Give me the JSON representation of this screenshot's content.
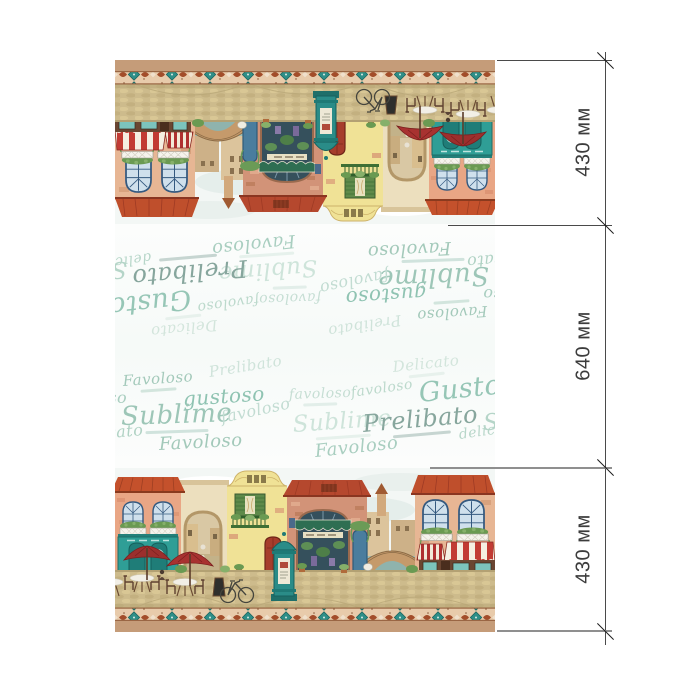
{
  "dimensions": {
    "unit": "мм",
    "segments": [
      {
        "label": "430 мм",
        "value": 430
      },
      {
        "label": "640 мм",
        "value": 640
      },
      {
        "label": "430 мм",
        "value": 430
      }
    ]
  },
  "panel": {
    "scatter_words": [
      {
        "text": "Favoloso",
        "x": 8,
        "y": 28,
        "size": 15,
        "color": "#a3c9ba",
        "rot": -4,
        "caption": true
      },
      {
        "text": "Prelibato",
        "x": 94,
        "y": 19,
        "size": 15,
        "color": "#cfe3da",
        "rot": -9
      },
      {
        "text": "Delicato",
        "x": 278,
        "y": 14,
        "size": 15,
        "color": "#d3e5dc",
        "rot": -6,
        "caption": true
      },
      {
        "text": "gustoso",
        "x": -54,
        "y": 44,
        "size": 16,
        "color": "#a9cec0",
        "rot": 0
      },
      {
        "text": "gustoso",
        "x": 68,
        "y": 43,
        "size": 20,
        "color": "#8fc3b2",
        "rot": -4
      },
      {
        "text": "favoloso",
        "x": 174,
        "y": 42,
        "size": 14,
        "color": "#c6ded4",
        "rot": -2,
        "caption": true
      },
      {
        "text": "favoloso",
        "x": 236,
        "y": 40,
        "size": 14,
        "color": "#bcd9cc",
        "rot": -8
      },
      {
        "text": "Gustoso",
        "x": 304,
        "y": 34,
        "size": 27,
        "color": "#96c6b6",
        "rot": -6
      },
      {
        "text": "Sublime",
        "x": 6,
        "y": 58,
        "size": 26,
        "color": "#9dc6b7",
        "rot": -2,
        "caption": true
      },
      {
        "text": "favoloso",
        "x": 106,
        "y": 64,
        "size": 16,
        "color": "#c2dcd2",
        "rot": -12
      },
      {
        "text": "Sublime",
        "x": 178,
        "y": 68,
        "size": 23,
        "color": "#cee4da",
        "rot": -4,
        "caption": true
      },
      {
        "text": "Prelibato",
        "x": 248,
        "y": 66,
        "size": 24,
        "color": "#87a69d",
        "rot": -5,
        "caption": true
      },
      {
        "text": "Sublime",
        "x": 368,
        "y": 66,
        "size": 23,
        "color": "#b5d5c8",
        "rot": 0
      },
      {
        "text": "delicato",
        "x": -40,
        "y": 82,
        "size": 16,
        "color": "#b0d2c4",
        "rot": -5
      },
      {
        "text": "delicato",
        "x": 344,
        "y": 82,
        "size": 14,
        "color": "#b7d6c9",
        "rot": -8
      },
      {
        "text": "Favoloso",
        "x": 44,
        "y": 90,
        "size": 18,
        "color": "#a3c9ba",
        "rot": -3
      },
      {
        "text": "Favoloso",
        "x": 200,
        "y": 97,
        "size": 18,
        "color": "#a9cec0",
        "rot": -6
      }
    ],
    "scene_elements": [
      "terracotta-house",
      "teal-storefront",
      "red-umbrellas",
      "cafe-tables",
      "stone-archway",
      "baroque-gable-house",
      "green-shutter-balcony",
      "red-door",
      "shop-with-green-awning",
      "advertising-column",
      "canal-bridge",
      "peach-house",
      "striped-awning-shop",
      "bicycle",
      "cobblestone-street",
      "ornamental-border",
      "tan-hem"
    ],
    "colors": {
      "roof": "#c4512c",
      "wall_salmon": "#e9a685",
      "wall_yellow": "#f0e296",
      "wall_peach": "#e7b694",
      "teal_storefront": "#2f9e96",
      "umbrella_red": "#9c2f2d",
      "band_bg": "#e8cbab",
      "hem_tan": "#c59c79",
      "word_green": "#9dc6b7",
      "word_dark": "#87a69d"
    }
  }
}
